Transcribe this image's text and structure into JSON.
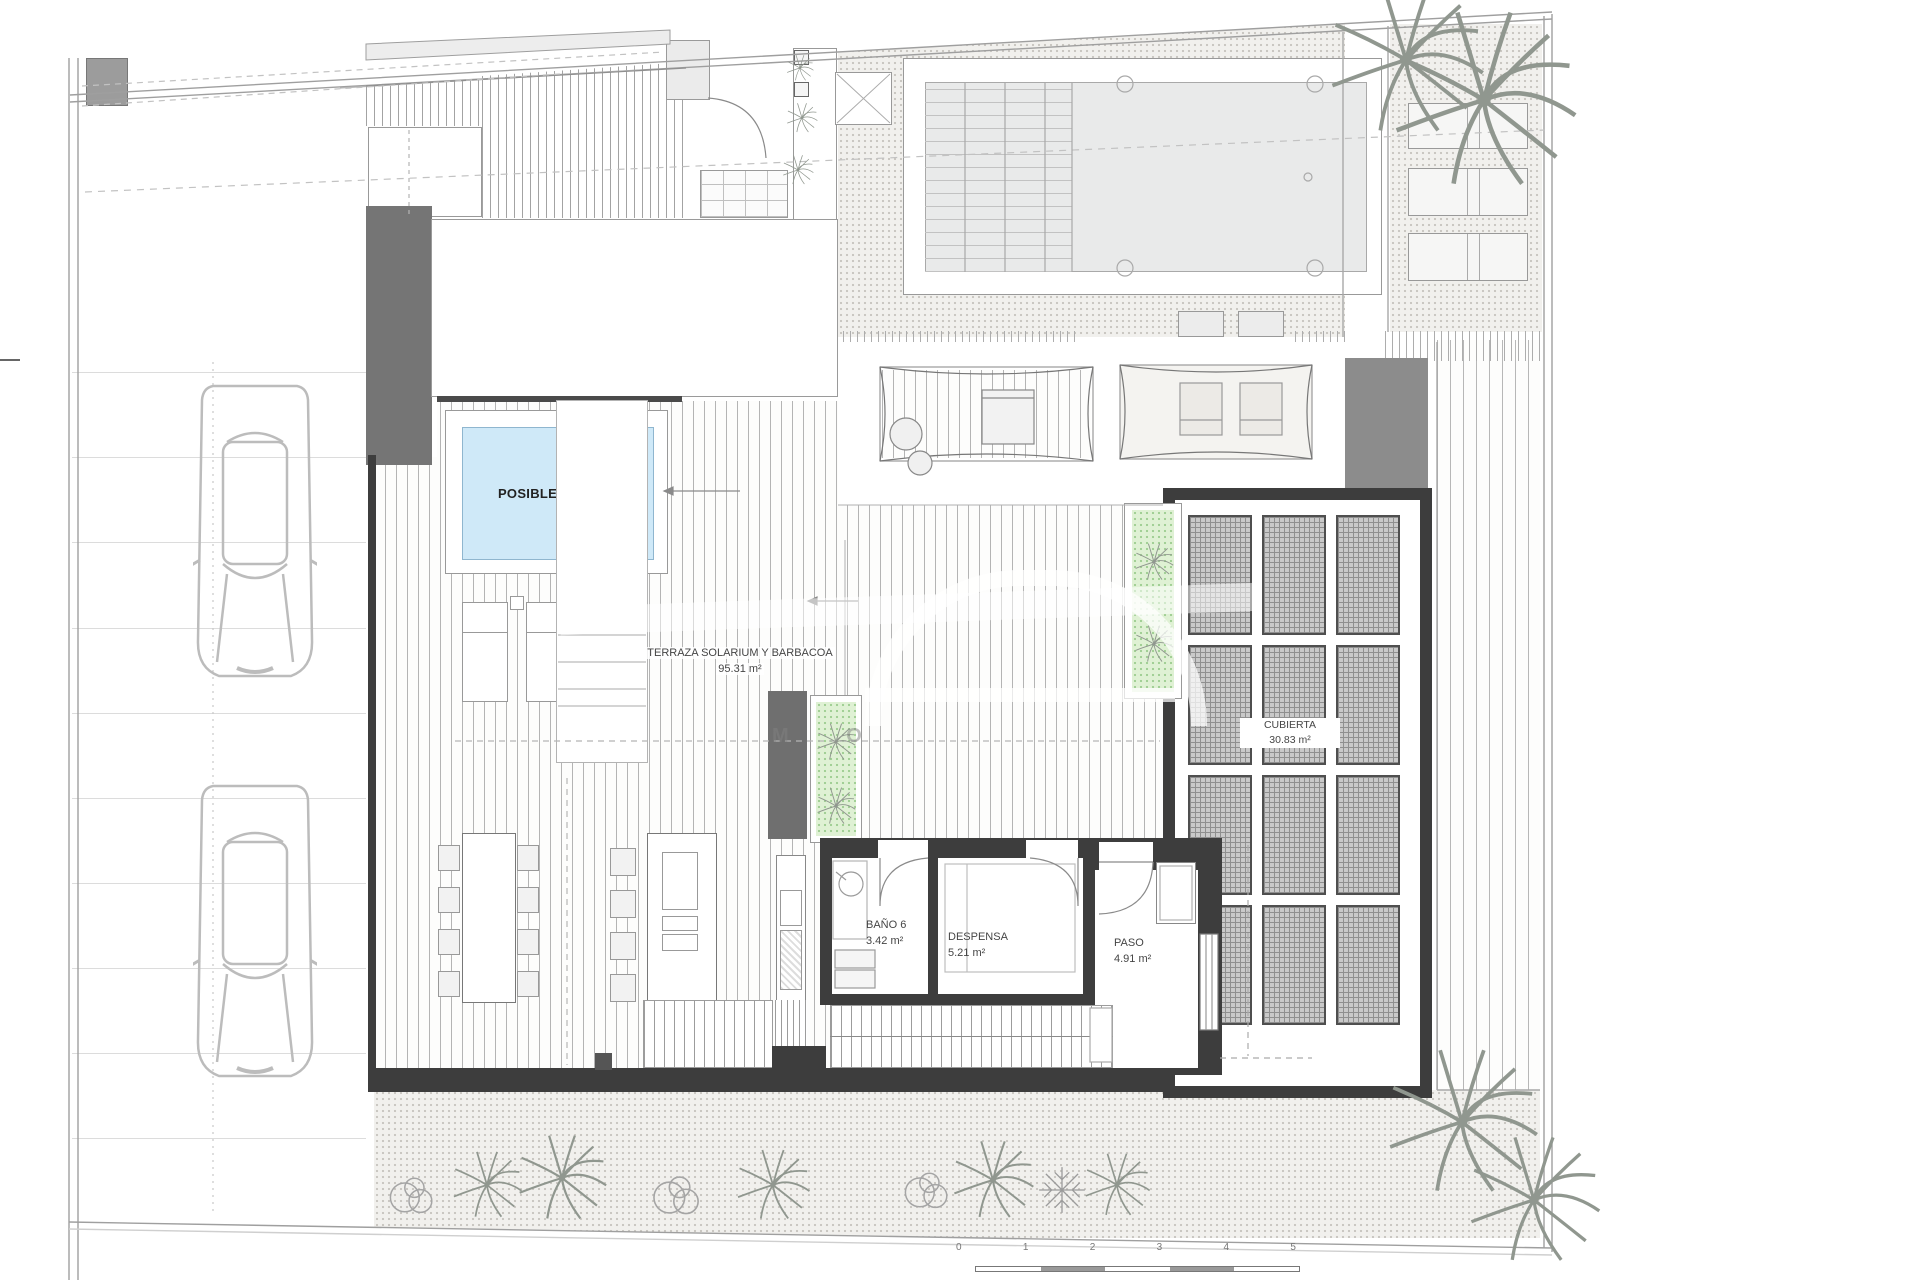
{
  "watermark": {
    "text": "M O"
  },
  "areas": {
    "jacuzzi": {
      "label": "POSIBLE JACUZZI"
    },
    "terrace": {
      "label": "TERRAZA SOLARIUM Y BARBACOA",
      "area": "95.31 m²"
    },
    "bathroom6": {
      "label": "BAÑO 6",
      "area": "3.42 m²"
    },
    "pantry": {
      "label": "DESPENSA",
      "area": "5.21 m²"
    },
    "hall": {
      "label": "PASO",
      "area": "4.91 m²"
    },
    "cover": {
      "label": "CUBIERTA",
      "area": "30.83 m²"
    }
  },
  "scalebar": {
    "labels": [
      "0",
      "1",
      "2",
      "3",
      "4",
      "5"
    ]
  },
  "colors": {
    "wall": "#3d3d3d",
    "jacuzzi_fill": "#cfe9f8",
    "planter_green": "#dff1d4",
    "volume_gray": "#7b7b7b"
  }
}
